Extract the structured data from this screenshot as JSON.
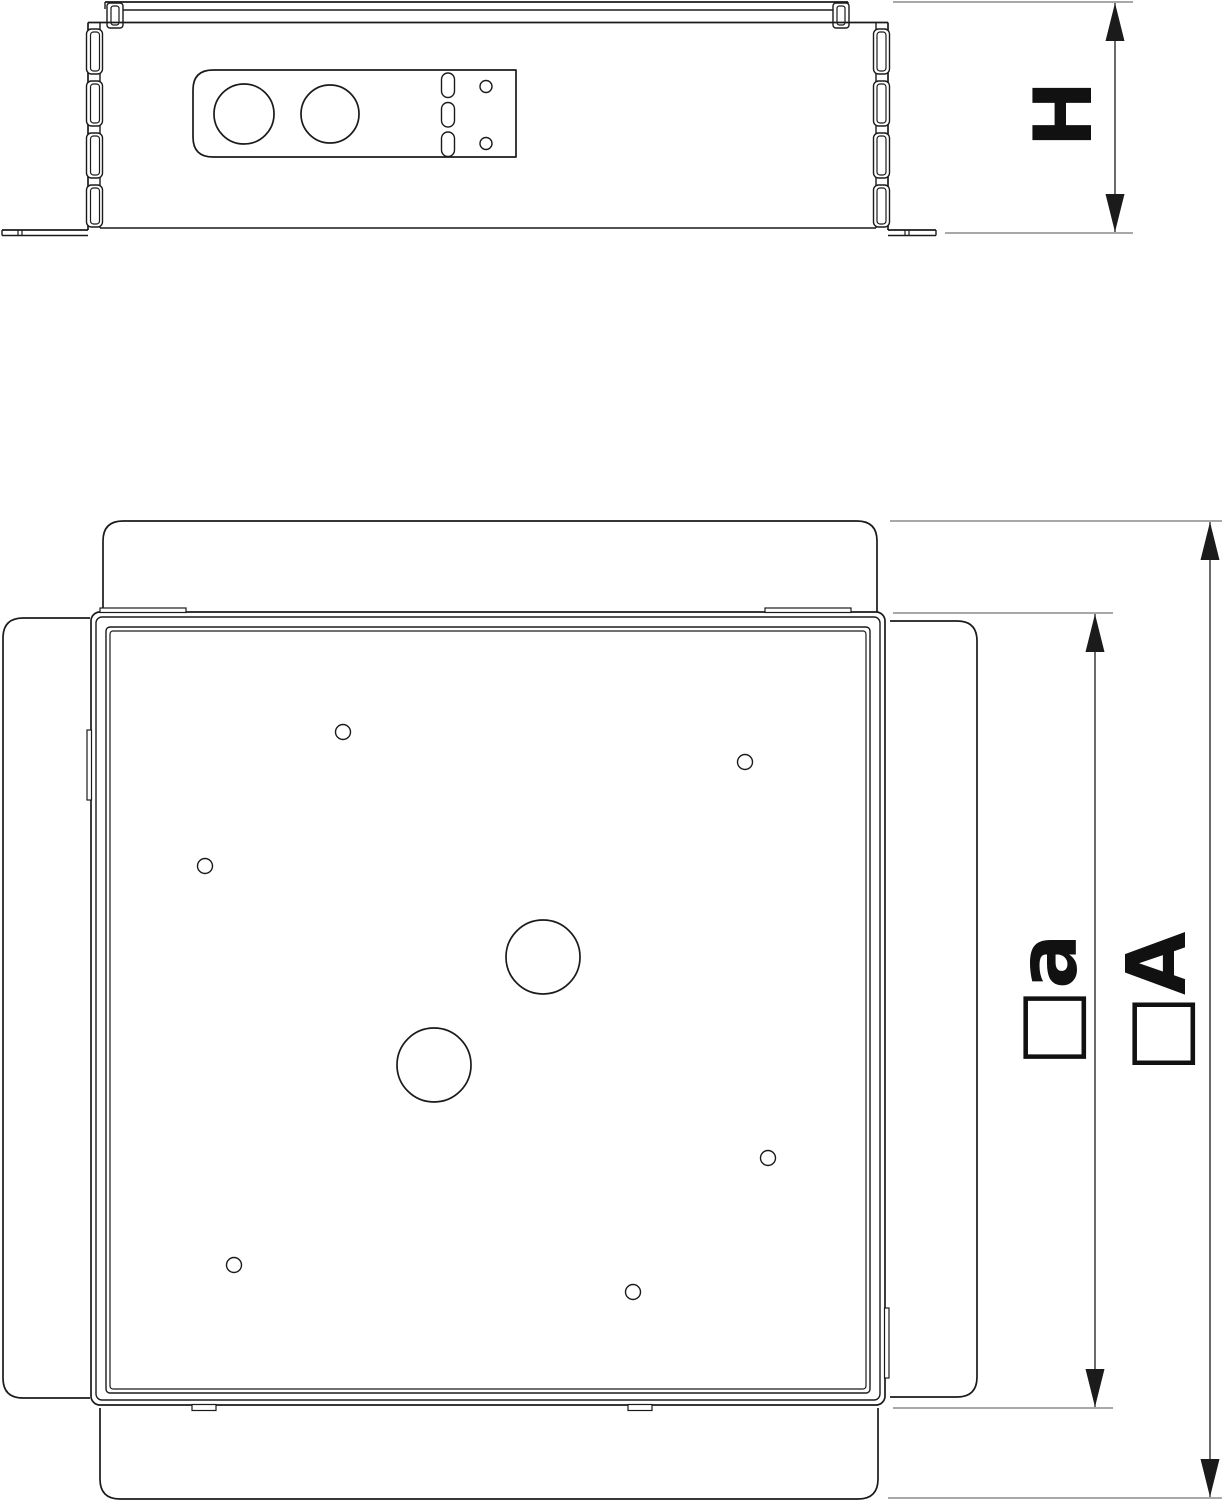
{
  "page": {
    "background_color": "#ffffff",
    "line_color": "#1b1b1b",
    "extension_line_color": "#8c8c8c"
  },
  "drawing": {
    "kind": "technical-dimension-drawing",
    "side_view": {
      "height_label": "H"
    },
    "plan_view": {
      "inner_width_label": "□a",
      "outer_width_label": "□A"
    }
  }
}
